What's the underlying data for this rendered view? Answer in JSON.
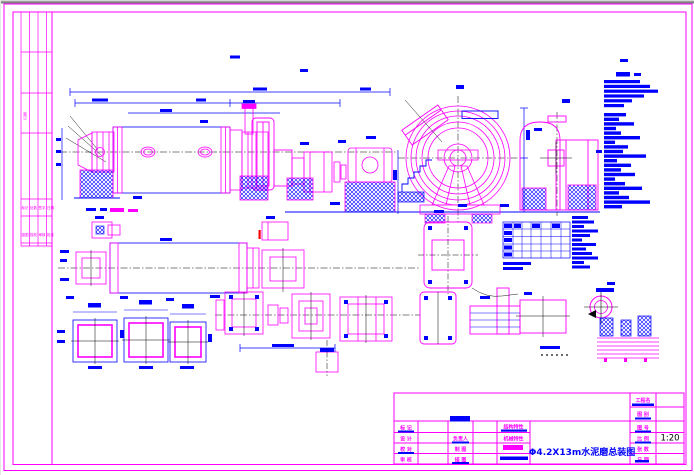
{
  "colors": {
    "line_magenta": "#ff00ff",
    "line_blue": "#0000ff",
    "line_black": "#000000",
    "accent_red": "#ff0000",
    "paper": "#ffffff",
    "window_strip": "#808080"
  },
  "title_block": {
    "right_labels": [
      "工程名",
      "图 别",
      "图 号",
      "比 例",
      "张 数",
      "日 期"
    ],
    "col1_labels": [
      "标 记",
      "设 计",
      "校 对",
      "审 核"
    ],
    "col2_labels": [
      "负责人",
      "制 图",
      "描 图"
    ],
    "col3_labels": [
      "结构特性",
      "机械特性"
    ],
    "scale_value": "1:20",
    "drawing_title": "Φ4.2X13m水泥磨总装图"
  },
  "left_strip": {
    "vertical_label": "装订",
    "row1_cells": [
      "标记",
      "处数",
      "签字",
      "日期"
    ],
    "row2_cells": [
      "描图",
      "描校",
      "审核",
      "批准"
    ]
  },
  "notes_column": {
    "legible": false,
    "line_count": 27
  },
  "parts_table": {
    "rows": 5,
    "columns": 7
  }
}
